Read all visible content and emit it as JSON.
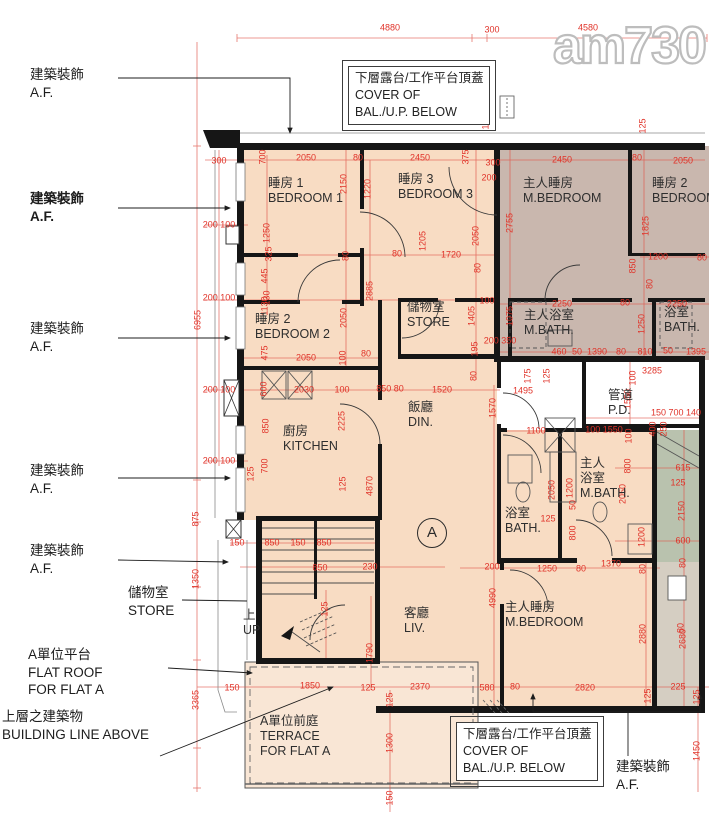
{
  "watermark": "am730",
  "unit_circle_label": "A",
  "colors": {
    "flat_fill": "#f8dcc3",
    "terrace_fill": "#f9e6d5",
    "other_flat_fill": "#c9b7ae",
    "service_green": "#b9c2ae",
    "lobby_gray": "#d5cec2",
    "dimension_red": "#e03228",
    "wall_black": "#161616"
  },
  "annotations": [
    {
      "lines": [
        "建築裝飾",
        "A.F."
      ],
      "x": 30,
      "y": 66,
      "bold": 0
    },
    {
      "lines": [
        "建築裝飾",
        "A.F."
      ],
      "x": 30,
      "y": 190,
      "bold": 1
    },
    {
      "lines": [
        "建築裝飾",
        "A.F."
      ],
      "x": 30,
      "y": 320,
      "bold": 0
    },
    {
      "lines": [
        "建築裝飾",
        "A.F."
      ],
      "x": 30,
      "y": 462,
      "bold": 0
    },
    {
      "lines": [
        "建築裝飾",
        "A.F."
      ],
      "x": 30,
      "y": 542,
      "bold": 0
    },
    {
      "lines": [
        "儲物室",
        "STORE"
      ],
      "x": 128,
      "y": 584,
      "bold": 0
    },
    {
      "lines": [
        "A單位平台",
        "FLAT ROOF",
        "FOR FLAT A"
      ],
      "x": 28,
      "y": 646,
      "bold": 0
    },
    {
      "lines": [
        "上層之建築物",
        "BUILDING LINE ABOVE"
      ],
      "x": 2,
      "y": 708,
      "bold": 0
    },
    {
      "lines": [
        "建築裝飾",
        "A.F."
      ],
      "x": 616,
      "y": 758,
      "bold": 0
    }
  ],
  "cover_boxes": [
    {
      "lines": [
        "下層露台/工作平台頂蓋",
        "COVER OF",
        "BAL./U.P. BELOW"
      ],
      "x": 348,
      "y": 66
    },
    {
      "lines": [
        "下層露台/工作平台頂蓋",
        "COVER OF",
        "BAL./U.P. BELOW"
      ],
      "x": 456,
      "y": 722
    }
  ],
  "rooms": [
    {
      "name": "bedroom-1",
      "lines": [
        "睡房 1",
        "BEDROOM 1"
      ],
      "x": 268,
      "y": 176
    },
    {
      "name": "bedroom-3",
      "lines": [
        "睡房 3",
        "BEDROOM 3"
      ],
      "x": 398,
      "y": 172
    },
    {
      "name": "m-bedroom-other",
      "lines": [
        "主人睡房",
        "M.BEDROOM"
      ],
      "x": 523,
      "y": 176
    },
    {
      "name": "bedroom-2-other",
      "lines": [
        "睡房 2",
        "BEDROOM 2"
      ],
      "x": 652,
      "y": 176
    },
    {
      "name": "bedroom-2",
      "lines": [
        "睡房 2",
        "BEDROOM 2"
      ],
      "x": 255,
      "y": 312
    },
    {
      "name": "store-upper",
      "lines": [
        "儲物室",
        "STORE"
      ],
      "x": 407,
      "y": 300
    },
    {
      "name": "m-bath-other",
      "lines": [
        "主人浴室",
        "M.BATH."
      ],
      "x": 524,
      "y": 308
    },
    {
      "name": "bath-other",
      "lines": [
        "浴室",
        "BATH."
      ],
      "x": 664,
      "y": 305
    },
    {
      "name": "kitchen",
      "lines": [
        "廚房",
        "KITCHEN"
      ],
      "x": 283,
      "y": 424
    },
    {
      "name": "dining",
      "lines": [
        "飯廳",
        "DIN."
      ],
      "x": 408,
      "y": 400
    },
    {
      "name": "pipe-duct",
      "lines": [
        "管道",
        "P.D."
      ],
      "x": 608,
      "y": 388
    },
    {
      "name": "m-bath",
      "lines": [
        "主人",
        "浴室",
        "M.BATH."
      ],
      "x": 580,
      "y": 456
    },
    {
      "name": "bath",
      "lines": [
        "浴室",
        "BATH."
      ],
      "x": 505,
      "y": 506
    },
    {
      "name": "living",
      "lines": [
        "客廳",
        "LIV."
      ],
      "x": 404,
      "y": 606
    },
    {
      "name": "m-bedroom",
      "lines": [
        "主人睡房",
        "M.BEDROOM"
      ],
      "x": 505,
      "y": 600
    },
    {
      "name": "stair-up",
      "lines": [
        "上",
        "UP"
      ],
      "x": 243,
      "y": 608
    },
    {
      "name": "terrace",
      "lines": [
        "A單位前庭",
        "TERRACE",
        "FOR FLAT A"
      ],
      "x": 260,
      "y": 714
    }
  ],
  "dims": [
    [
      "4880",
      390,
      28,
      0
    ],
    [
      "300",
      492,
      30,
      0
    ],
    [
      "4580",
      588,
      28,
      0
    ],
    [
      "300",
      219,
      161,
      0
    ],
    [
      "700",
      263,
      157,
      1
    ],
    [
      "2050",
      306,
      158,
      0
    ],
    [
      "80",
      358,
      158,
      0
    ],
    [
      "2450",
      420,
      158,
      0
    ],
    [
      "375",
      466,
      157,
      1
    ],
    [
      "300",
      493,
      163,
      0
    ],
    [
      "200",
      489,
      178,
      0
    ],
    [
      "2450",
      562,
      160,
      0
    ],
    [
      "80",
      637,
      158,
      0
    ],
    [
      "2050",
      683,
      161,
      0
    ],
    [
      "125",
      486,
      122,
      1
    ],
    [
      "125",
      643,
      126,
      1
    ],
    [
      "2150",
      344,
      184,
      1
    ],
    [
      "1220",
      368,
      189,
      1
    ],
    [
      "2755",
      510,
      223,
      1
    ],
    [
      "2050",
      476,
      236,
      1
    ],
    [
      "1825",
      646,
      226,
      1
    ],
    [
      "1205",
      423,
      241,
      1
    ],
    [
      "1250",
      267,
      233,
      1
    ],
    [
      "200 100",
      219,
      225,
      0
    ],
    [
      "80",
      346,
      256,
      1
    ],
    [
      "325",
      269,
      254,
      1
    ],
    [
      "445",
      265,
      276,
      1
    ],
    [
      "130",
      267,
      298,
      1
    ],
    [
      "2885",
      370,
      291,
      1
    ],
    [
      "80",
      397,
      254,
      0
    ],
    [
      "1720",
      451,
      255,
      0
    ],
    [
      "80",
      478,
      268,
      1
    ],
    [
      "1200",
      658,
      257,
      0
    ],
    [
      "80",
      702,
      258,
      0
    ],
    [
      "850",
      633,
      266,
      1
    ],
    [
      "80",
      650,
      284,
      1
    ],
    [
      "100",
      487,
      301,
      0
    ],
    [
      "2250",
      562,
      304,
      0
    ],
    [
      "80",
      625,
      303,
      0
    ],
    [
      "2250",
      677,
      304,
      0
    ],
    [
      "200 100",
      219,
      298,
      0
    ],
    [
      "6955",
      198,
      320,
      1
    ],
    [
      "1130",
      265,
      306,
      1
    ],
    [
      "2050",
      344,
      318,
      1
    ],
    [
      "1405",
      472,
      316,
      1
    ],
    [
      "1075",
      510,
      316,
      1
    ],
    [
      "1250",
      642,
      324,
      1
    ],
    [
      "475",
      265,
      353,
      1
    ],
    [
      "2050",
      306,
      358,
      0
    ],
    [
      "100",
      343,
      358,
      1
    ],
    [
      "80",
      366,
      354,
      0
    ],
    [
      "200 350",
      500,
      341,
      0
    ],
    [
      "195",
      475,
      349,
      1
    ],
    [
      "460",
      559,
      352,
      0
    ],
    [
      "50",
      577,
      352,
      0
    ],
    [
      "1390",
      597,
      352,
      0
    ],
    [
      "80",
      621,
      352,
      0
    ],
    [
      "810",
      645,
      352,
      0
    ],
    [
      "50",
      668,
      351,
      0
    ],
    [
      "1395",
      696,
      352,
      0
    ],
    [
      "3285",
      652,
      371,
      0
    ],
    [
      "100",
      633,
      378,
      1
    ],
    [
      "80",
      474,
      376,
      1
    ],
    [
      "175",
      528,
      376,
      1
    ],
    [
      "125",
      547,
      376,
      1
    ],
    [
      "200 100",
      219,
      390,
      0
    ],
    [
      "600",
      264,
      389,
      1
    ],
    [
      "2030",
      304,
      390,
      0
    ],
    [
      "100",
      342,
      390,
      0
    ],
    [
      "850 80",
      390,
      389,
      0
    ],
    [
      "1520",
      442,
      390,
      0
    ],
    [
      "1495",
      523,
      391,
      0
    ],
    [
      "1570",
      493,
      408,
      1
    ],
    [
      "850",
      266,
      426,
      1
    ],
    [
      "2225",
      342,
      421,
      1
    ],
    [
      "1550",
      628,
      399,
      1
    ],
    [
      "150 700 140",
      676,
      413,
      0
    ],
    [
      "100 1550",
      604,
      430,
      0
    ],
    [
      "1100",
      536,
      431,
      0
    ],
    [
      "100",
      629,
      436,
      1
    ],
    [
      "400",
      653,
      429,
      1
    ],
    [
      "250",
      664,
      429,
      1
    ],
    [
      "200 100",
      219,
      461,
      0
    ],
    [
      "125",
      251,
      474,
      1
    ],
    [
      "700",
      265,
      466,
      1
    ],
    [
      "125",
      343,
      484,
      1
    ],
    [
      "4870",
      370,
      486,
      1
    ],
    [
      "875",
      196,
      519,
      1
    ],
    [
      "800",
      628,
      466,
      1
    ],
    [
      "615",
      683,
      468,
      0
    ],
    [
      "125",
      678,
      483,
      0
    ],
    [
      "2150",
      682,
      511,
      1
    ],
    [
      "2050",
      552,
      490,
      1
    ],
    [
      "1200",
      570,
      488,
      1
    ],
    [
      "50",
      573,
      505,
      1
    ],
    [
      "2050",
      623,
      494,
      1
    ],
    [
      "125",
      548,
      519,
      0
    ],
    [
      "800",
      573,
      533,
      1
    ],
    [
      "1200",
      642,
      537,
      1
    ],
    [
      "600",
      683,
      541,
      0
    ],
    [
      "80",
      683,
      563,
      1
    ],
    [
      "150",
      237,
      543,
      0
    ],
    [
      "850",
      272,
      543,
      0
    ],
    [
      "150",
      298,
      543,
      0
    ],
    [
      "850",
      324,
      543,
      0
    ],
    [
      "850",
      320,
      568,
      0
    ],
    [
      "230",
      370,
      567,
      0
    ],
    [
      "1350",
      196,
      579,
      1
    ],
    [
      "125",
      325,
      609,
      1
    ],
    [
      "4990",
      493,
      598,
      1
    ],
    [
      "200",
      492,
      567,
      0
    ],
    [
      "1250",
      547,
      569,
      0
    ],
    [
      "80",
      581,
      569,
      0
    ],
    [
      "1370",
      611,
      564,
      0
    ],
    [
      "80",
      643,
      569,
      1
    ],
    [
      "2880",
      643,
      634,
      1
    ],
    [
      "2680",
      683,
      639,
      1
    ],
    [
      "80",
      681,
      628,
      1
    ],
    [
      "1790",
      370,
      653,
      1
    ],
    [
      "3365",
      196,
      700,
      1
    ],
    [
      "150",
      232,
      688,
      0
    ],
    [
      "1850",
      310,
      686,
      0
    ],
    [
      "125",
      368,
      688,
      0
    ],
    [
      "2370",
      420,
      687,
      0
    ],
    [
      "125",
      390,
      700,
      1
    ],
    [
      "580",
      487,
      688,
      0
    ],
    [
      "80",
      515,
      687,
      0
    ],
    [
      "2820",
      585,
      688,
      0
    ],
    [
      "125",
      648,
      696,
      1
    ],
    [
      "225",
      678,
      687,
      0
    ],
    [
      "125",
      697,
      697,
      1
    ],
    [
      "1450",
      697,
      751,
      1
    ],
    [
      "1300",
      390,
      743,
      1
    ],
    [
      "150",
      390,
      798,
      1
    ]
  ]
}
